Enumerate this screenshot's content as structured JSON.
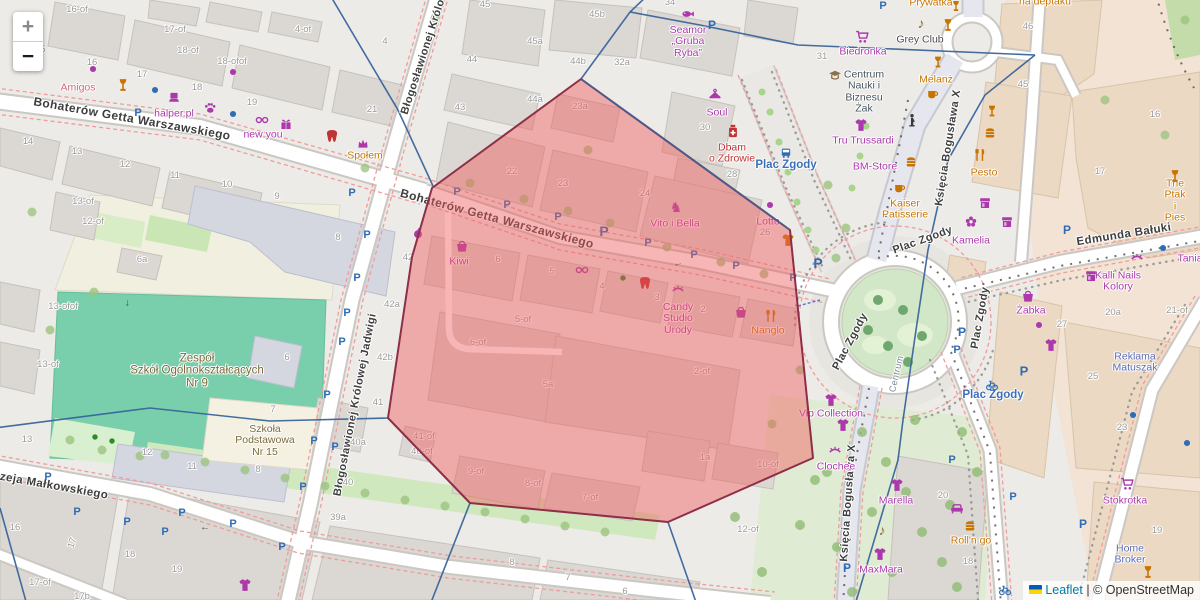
{
  "controls": {
    "zoom_in_label": "+",
    "zoom_out_label": "−"
  },
  "attribution": {
    "flag_icon": "ukraine-flag",
    "leaflet_link": "Leaflet",
    "separator": " | ",
    "copyright": "© OpenStreetMap"
  },
  "selection": {
    "points": "581,79 790,230 813,458 668,522 470,503 388,418 412,257 432,188",
    "fill": "#F05C5C",
    "fill_opacity": 0.45,
    "stroke": "#8D2F47"
  },
  "street_labels": [
    [
      "Bohaterów Getta Warszawskiego",
      132,
      119,
      10,
      12
    ],
    [
      "Bohaterów Getta Warszawskiego",
      497,
      219,
      15,
      12
    ],
    [
      "Błogosławionej Królowej Jadwigi",
      434,
      26,
      -72,
      11
    ],
    [
      "Błogosławionej Królowej Jadwigi",
      356,
      405,
      -79,
      11
    ],
    [
      "Andrzeja Małkowskiego",
      40,
      484,
      10,
      11.5
    ],
    [
      "Księcia Bogusława X",
      949,
      148,
      -81,
      11
    ],
    [
      "Księcia Bogusława X",
      849,
      503,
      -86,
      11
    ],
    [
      "Edmunda Bałuki",
      1124,
      235,
      -9,
      11.5
    ],
    [
      "Plac Zgody",
      923,
      241,
      -20,
      11
    ],
    [
      "Plac Zgody",
      981,
      318,
      -80,
      11
    ],
    [
      "Plac Zgody",
      851,
      342,
      -62,
      11
    ],
    [
      "Centrum",
      897,
      374,
      -77,
      9,
      "#7B8795"
    ]
  ],
  "place_labels": [
    [
      "Plac Zgody",
      786,
      165
    ],
    [
      "Plac Zgody",
      993,
      395
    ]
  ],
  "pois": [
    [
      "Amigos",
      78,
      88,
      "pink"
    ],
    [
      "halper.pl",
      174,
      114,
      "shop"
    ],
    [
      "new you",
      263,
      135,
      "shop"
    ],
    [
      "Społem",
      365,
      156,
      "food"
    ],
    [
      "Seamor\n„Gruba\nRyba”",
      688,
      42,
      "shop"
    ],
    [
      "na deptaku",
      1045,
      2,
      "food"
    ],
    [
      "Prywatka",
      931,
      3,
      "food"
    ],
    [
      "Grey Club",
      920,
      40,
      "dark"
    ],
    [
      "Biedronka",
      863,
      52,
      "shop"
    ],
    [
      "Melanż",
      936,
      80,
      "food"
    ],
    [
      "Centrum\nNauki i\nBiznesu\nŻak",
      864,
      92,
      "edu"
    ],
    [
      "Soul",
      717,
      113,
      "shop"
    ],
    [
      "Dbam\no Zdrowie",
      732,
      154,
      "health"
    ],
    [
      "Tru Trussardi",
      863,
      141,
      "shop"
    ],
    [
      "BM-Store",
      875,
      167,
      "shop"
    ],
    [
      "Kaiser\nPatisserie",
      905,
      210,
      "food"
    ],
    [
      "Pesto",
      984,
      173,
      "food"
    ],
    [
      "The Ptak\ni Pies",
      1175,
      201,
      "food"
    ],
    [
      "Kamelia",
      971,
      241,
      "shop"
    ],
    [
      "Tania",
      1190,
      259,
      "shop"
    ],
    [
      "Kalli Nails\nKolory",
      1118,
      282,
      "shop"
    ],
    [
      "Żabka",
      1031,
      311,
      "shop"
    ],
    [
      "Reklama\nMatuszak",
      1135,
      363,
      "office"
    ],
    [
      "Kiwi",
      459,
      262,
      "shop"
    ],
    [
      "Vito i Bella",
      675,
      224,
      "shop"
    ],
    [
      "Lotto",
      768,
      222,
      "shop"
    ],
    [
      "Candy\nStudio\nUrody",
      678,
      319,
      "shop"
    ],
    [
      "Nanglo",
      768,
      331,
      "food"
    ],
    [
      "Vip Collection",
      831,
      414,
      "shop"
    ],
    [
      "Clochee",
      836,
      467,
      "shop"
    ],
    [
      "Marella",
      896,
      501,
      "shop"
    ],
    [
      "MaxMara",
      881,
      570,
      "shop"
    ],
    [
      "Roll'n go",
      971,
      541,
      "food"
    ],
    [
      "Stokrotka",
      1125,
      501,
      "shop"
    ],
    [
      "Home\nBroker",
      1130,
      555,
      "office"
    ],
    [
      "Zespół\nSzkół Ogólnokształcących\nNr 9",
      197,
      371,
      "school-lg"
    ],
    [
      "Szkoła\nPodstawowa\nNr 15",
      265,
      441,
      "school"
    ]
  ],
  "house_numbers": [
    [
      92,
      63,
      "16"
    ],
    [
      142,
      75,
      "17"
    ],
    [
      197,
      88,
      "18"
    ],
    [
      252,
      103,
      "19"
    ],
    [
      372,
      110,
      "21"
    ],
    [
      77,
      10,
      "16-of"
    ],
    [
      175,
      30,
      "17-of"
    ],
    [
      188,
      51,
      "18-of"
    ],
    [
      232,
      62,
      "18-ofof"
    ],
    [
      303,
      30,
      "4-of"
    ],
    [
      385,
      42,
      "4"
    ],
    [
      43,
      50,
      "5"
    ],
    [
      28,
      142,
      "14"
    ],
    [
      77,
      152,
      "13"
    ],
    [
      125,
      165,
      "12"
    ],
    [
      175,
      176,
      "11"
    ],
    [
      227,
      185,
      "10"
    ],
    [
      277,
      197,
      "9"
    ],
    [
      83,
      202,
      "13-of"
    ],
    [
      93,
      222,
      "12-of"
    ],
    [
      338,
      238,
      "8"
    ],
    [
      142,
      260,
      "6a"
    ],
    [
      63,
      307,
      "13-ofof"
    ],
    [
      48,
      365,
      "13-of"
    ],
    [
      287,
      358,
      "6"
    ],
    [
      408,
      258,
      "42"
    ],
    [
      392,
      305,
      "42a"
    ],
    [
      385,
      358,
      "42b"
    ],
    [
      378,
      403,
      "41"
    ],
    [
      358,
      443,
      "40a"
    ],
    [
      348,
      483,
      "40"
    ],
    [
      338,
      518,
      "39a"
    ],
    [
      27,
      440,
      "13"
    ],
    [
      147,
      453,
      "12"
    ],
    [
      192,
      467,
      "11"
    ],
    [
      258,
      470,
      "8"
    ],
    [
      273,
      410,
      "7"
    ],
    [
      15,
      528,
      "16"
    ],
    [
      73,
      543,
      "17",
      -72
    ],
    [
      130,
      555,
      "18"
    ],
    [
      177,
      570,
      "19"
    ],
    [
      40,
      583,
      "17-of"
    ],
    [
      82,
      597,
      "17b"
    ],
    [
      485,
      5,
      "45"
    ],
    [
      597,
      15,
      "45b"
    ],
    [
      535,
      42,
      "45a"
    ],
    [
      472,
      60,
      "44"
    ],
    [
      578,
      62,
      "44b"
    ],
    [
      622,
      63,
      "32a"
    ],
    [
      670,
      3,
      "34"
    ],
    [
      535,
      100,
      "44a"
    ],
    [
      580,
      107,
      "23a"
    ],
    [
      460,
      108,
      "43"
    ],
    [
      822,
      57,
      "31"
    ],
    [
      512,
      172,
      "22"
    ],
    [
      563,
      184,
      "23"
    ],
    [
      645,
      194,
      "24"
    ],
    [
      705,
      128,
      "30"
    ],
    [
      732,
      175,
      "28"
    ],
    [
      765,
      233,
      "26"
    ],
    [
      498,
      260,
      "6"
    ],
    [
      552,
      272,
      "5"
    ],
    [
      602,
      287,
      "4"
    ],
    [
      657,
      298,
      "3"
    ],
    [
      703,
      310,
      "2"
    ],
    [
      523,
      320,
      "5-of"
    ],
    [
      478,
      343,
      "6-of"
    ],
    [
      702,
      372,
      "2-of"
    ],
    [
      548,
      385,
      "5a"
    ],
    [
      424,
      437,
      "41-of"
    ],
    [
      422,
      452,
      "40-of"
    ],
    [
      476,
      472,
      "9-of"
    ],
    [
      533,
      484,
      "8-of"
    ],
    [
      590,
      498,
      "7-of"
    ],
    [
      705,
      458,
      "1a"
    ],
    [
      768,
      465,
      "10-of"
    ],
    [
      748,
      530,
      "12-of"
    ],
    [
      512,
      563,
      "8"
    ],
    [
      568,
      578,
      "7"
    ],
    [
      625,
      592,
      "6"
    ],
    [
      1028,
      27,
      "46"
    ],
    [
      1023,
      85,
      "45"
    ],
    [
      1155,
      115,
      "16"
    ],
    [
      1100,
      172,
      "17"
    ],
    [
      1113,
      313,
      "20a"
    ],
    [
      1177,
      311,
      "21-of"
    ],
    [
      1062,
      325,
      "27"
    ],
    [
      1093,
      377,
      "25"
    ],
    [
      1122,
      428,
      "23"
    ],
    [
      1157,
      531,
      "19"
    ],
    [
      943,
      496,
      "20"
    ],
    [
      968,
      562,
      "18"
    ]
  ],
  "icons": [
    [
      "g:P",
      138,
      113,
      "#2E6CB5",
      11
    ],
    [
      "g:P",
      352,
      193,
      "#2E6CB5",
      11
    ],
    [
      "g:P",
      367,
      235,
      "#2E6CB5",
      11
    ],
    [
      "g:P",
      357,
      278,
      "#2E6CB5",
      11
    ],
    [
      "g:P",
      347,
      313,
      "#2E6CB5",
      11
    ],
    [
      "g:P",
      342,
      342,
      "#2E6CB5",
      11
    ],
    [
      "g:P",
      327,
      395,
      "#2E6CB5",
      11
    ],
    [
      "g:P",
      314,
      441,
      "#2E6CB5",
      11
    ],
    [
      "g:P",
      335,
      447,
      "#2E6CB5",
      11
    ],
    [
      "g:P",
      303,
      487,
      "#2E6CB5",
      11
    ],
    [
      "g:P",
      48,
      477,
      "#2E6CB5",
      11
    ],
    [
      "g:P",
      77,
      512,
      "#2E6CB5",
      11
    ],
    [
      "g:P",
      127,
      522,
      "#2E6CB5",
      11
    ],
    [
      "g:P",
      165,
      532,
      "#2E6CB5",
      11
    ],
    [
      "g:P",
      182,
      513,
      "#2E6CB5",
      11
    ],
    [
      "g:P",
      233,
      524,
      "#2E6CB5",
      11
    ],
    [
      "g:P",
      282,
      547,
      "#2E6CB5",
      11
    ],
    [
      "g:P",
      457,
      192,
      "#2E6CB5",
      11
    ],
    [
      "g:P",
      507,
      205,
      "#2E6CB5",
      11
    ],
    [
      "g:P",
      558,
      217,
      "#2E6CB5",
      11
    ],
    [
      "g:P",
      604,
      231,
      "#2E6CB5",
      14
    ],
    [
      "g:P",
      648,
      243,
      "#2E6CB5",
      11
    ],
    [
      "g:P",
      694,
      255,
      "#2E6CB5",
      11
    ],
    [
      "g:P",
      736,
      266,
      "#2E6CB5",
      11
    ],
    [
      "g:P",
      793,
      278,
      "#2E6CB5",
      11
    ],
    [
      "g:P",
      818,
      263,
      "#2E6CB5",
      14
    ],
    [
      "g:P",
      712,
      25,
      "#2E6CB5",
      12
    ],
    [
      "g:P",
      883,
      6,
      "#2E6CB5",
      11
    ],
    [
      "g:P",
      962,
      332,
      "#2E6CB5",
      12
    ],
    [
      "g:P",
      957,
      350,
      "#2E6CB5",
      11
    ],
    [
      "g:P",
      1024,
      371,
      "#2E6CB5",
      13
    ],
    [
      "g:P",
      952,
      460,
      "#2E6CB5",
      11
    ],
    [
      "g:P",
      1013,
      497,
      "#2E6CB5",
      11
    ],
    [
      "g:P",
      1083,
      524,
      "#2E6CB5",
      12
    ],
    [
      "g:P",
      847,
      568,
      "#2E6CB5",
      12
    ],
    [
      "g:P",
      1067,
      230,
      "#2E6CB5",
      12
    ],
    [
      "g:♪",
      921,
      23,
      "#8A6D3B",
      14
    ],
    [
      "g:♪",
      882,
      530,
      "#8A6D3B",
      14
    ],
    [
      "g:♞",
      676,
      207,
      "#AC39AC",
      14
    ],
    [
      "g:←",
      205,
      528,
      "#4A4A4A",
      10
    ],
    [
      "g:←",
      127,
      303,
      "#4A4A4A",
      10,
      -90
    ],
    [
      "g:←",
      678,
      264,
      "#4A4A4A",
      10,
      -15
    ],
    [
      "wine",
      123,
      85,
      "#C77400",
      13
    ],
    [
      "wine",
      948,
      25,
      "#C77400",
      13
    ],
    [
      "wine",
      956,
      6,
      "#C77400",
      11
    ],
    [
      "wine",
      938,
      62,
      "#C77400",
      12
    ],
    [
      "wine",
      992,
      111,
      "#C77400",
      12
    ],
    [
      "wine",
      1175,
      176,
      "#C77400",
      13
    ],
    [
      "wine",
      1148,
      572,
      "#C77400",
      13
    ],
    [
      "laptop",
      174,
      97,
      "#AC39AC",
      12
    ],
    [
      "paw",
      210,
      108,
      "#AC39AC",
      12
    ],
    [
      "glasses",
      262,
      120,
      "#AC39AC",
      13
    ],
    [
      "glasses",
      582,
      270,
      "#AC39AC",
      13
    ],
    [
      "gift",
      286,
      124,
      "#AC39AC",
      12
    ],
    [
      "tooth",
      332,
      136,
      "#C13333",
      13
    ],
    [
      "tooth",
      645,
      283,
      "#C13333",
      13
    ],
    [
      "crown",
      363,
      144,
      "#AC39AC",
      12
    ],
    [
      "dot",
      233,
      72,
      "#AC39AC",
      9
    ],
    [
      "dot",
      93,
      69,
      "#AC39AC",
      9
    ],
    [
      "dot",
      1039,
      325,
      "#AC39AC",
      9
    ],
    [
      "dot",
      770,
      205,
      "#AC39AC",
      9
    ],
    [
      "dot",
      155,
      90,
      "#2E6CB5",
      9
    ],
    [
      "dot",
      233,
      114,
      "#2E6CB5",
      9
    ],
    [
      "dot",
      1163,
      248,
      "#2E6CB5",
      9
    ],
    [
      "dot",
      1133,
      415,
      "#2E6CB5",
      9
    ],
    [
      "dot",
      1187,
      443,
      "#2E6CB5",
      9
    ],
    [
      "dot",
      623,
      278,
      "#2E8B2E",
      8
    ],
    [
      "dot",
      95,
      437,
      "#2E8B2E",
      8
    ],
    [
      "dot",
      112,
      441,
      "#2E8B2E",
      8
    ],
    [
      "apple",
      418,
      233,
      "#AC39AC",
      12
    ],
    [
      "basket",
      462,
      246,
      "#AC39AC",
      13
    ],
    [
      "basket",
      1028,
      296,
      "#AC39AC",
      13
    ],
    [
      "basket",
      741,
      312,
      "#AC39AC",
      13
    ],
    [
      "fish",
      688,
      14,
      "#AC39AC",
      13
    ],
    [
      "cart",
      862,
      37,
      "#AC39AC",
      13
    ],
    [
      "cart",
      1127,
      484,
      "#AC39AC",
      13
    ],
    [
      "cup",
      933,
      94,
      "#C77400",
      12
    ],
    [
      "cup",
      900,
      188,
      "#C77400",
      12
    ],
    [
      "school",
      835,
      76,
      "#8B6F47",
      13
    ],
    [
      "person",
      912,
      120,
      "#3A3A3A",
      13
    ],
    [
      "shirt",
      861,
      125,
      "#AC39AC",
      13
    ],
    [
      "shirt",
      1051,
      345,
      "#AC39AC",
      13
    ],
    [
      "shirt",
      831,
      400,
      "#AC39AC",
      13
    ],
    [
      "shirt",
      843,
      425,
      "#AC39AC",
      13
    ],
    [
      "shirt",
      897,
      485,
      "#AC39AC",
      13
    ],
    [
      "shirt",
      880,
      554,
      "#AC39AC",
      13
    ],
    [
      "shirt",
      245,
      585,
      "#AC39AC",
      13
    ],
    [
      "shirt",
      788,
      240,
      "#C77400",
      13
    ],
    [
      "burger",
      911,
      162,
      "#C77400",
      12
    ],
    [
      "burger",
      990,
      133,
      "#C77400",
      12
    ],
    [
      "burger",
      970,
      526,
      "#C77400",
      12
    ],
    [
      "flower",
      971,
      222,
      "#AC39AC",
      13
    ],
    [
      "awning",
      985,
      203,
      "#AC39AC",
      12
    ],
    [
      "awning",
      1007,
      222,
      "#AC39AC",
      12
    ],
    [
      "awning",
      1091,
      276,
      "#AC39AC",
      12
    ],
    [
      "cutlery",
      980,
      155,
      "#C77400",
      13
    ],
    [
      "cutlery",
      771,
      316,
      "#C77400",
      13
    ],
    [
      "eyelash",
      1137,
      258,
      "#AC39AC",
      13
    ],
    [
      "eyelash",
      678,
      290,
      "#AC39AC",
      13
    ],
    [
      "eyelash",
      835,
      451,
      "#AC39AC",
      13
    ],
    [
      "medbottle",
      733,
      131,
      "#C13333",
      14
    ],
    [
      "hanger",
      715,
      95,
      "#AC39AC",
      13
    ],
    [
      "bus",
      786,
      153,
      "#2E6CB5",
      11
    ],
    [
      "bike",
      992,
      385,
      "#2E6CB5",
      12
    ],
    [
      "bike",
      1005,
      590,
      "#2E6CB5",
      12
    ],
    [
      "sofa",
      957,
      509,
      "#AC39AC",
      13
    ]
  ]
}
